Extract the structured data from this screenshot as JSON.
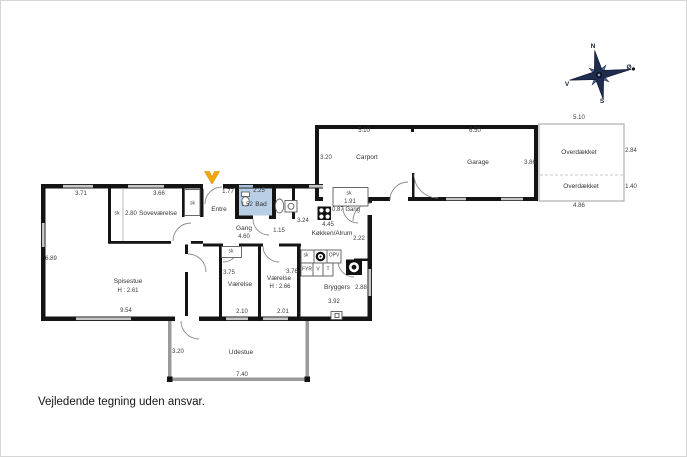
{
  "caption": "Vejledende tegning uden ansvar.",
  "colors": {
    "wall": "#141414",
    "window": "#c6c6c6",
    "bath_fill": "#b9cfe6",
    "entrance_marker": "#f3a70b",
    "compass_dark": "#1e2c4e",
    "compass_mid": "#4a6490"
  },
  "compass": {
    "n": "N",
    "e": "Ø",
    "s": "S",
    "v": "V"
  },
  "plan": {
    "house": {
      "spisestue": {
        "name": "Spisestue",
        "height": "H : 2.61",
        "dim_top": "3.71",
        "dim_left": "6.89",
        "dim_bottom": "9.54"
      },
      "sovevaerelse": {
        "name": "Soveværelse",
        "dim_top": "3.66",
        "dim_width": "2.80",
        "closet": "sk"
      },
      "entre": {
        "name": "Entre",
        "dim": "1.77",
        "closet": "sk"
      },
      "bad": {
        "name": "Bad",
        "dim_w": "2.25",
        "dim_h": "1.52"
      },
      "gang": {
        "name": "Gang",
        "dim": "4.60",
        "dim2": "1.15"
      },
      "koekken": {
        "name": "Køkken/Alrum",
        "dim1": "3.24",
        "dim2": "4.45",
        "dim3": "2.22",
        "closet": "sk",
        "closet_dim": "1.91",
        "gang_dim": "0.87 Gang"
      },
      "vaerelse1": {
        "name": "Værelse",
        "dim": "3.75",
        "dim_bottom": "2.10",
        "closet": "sk"
      },
      "vaerelse2": {
        "name": "Værelse",
        "height": "H : 2.66",
        "dim": "3.76",
        "dim_bottom": "2.01"
      },
      "bryggers": {
        "name": "Bryggers",
        "dim": "2.88",
        "dim_bottom": "3.92",
        "closet": "sk",
        "opv": "OPV",
        "fyr": "FYR",
        "v": "V",
        "t": "T"
      }
    },
    "carport": {
      "name": "Carport",
      "dim_top": "5.10",
      "dim_left": "3.20"
    },
    "garage": {
      "name": "Garage",
      "dim_top": "6.50",
      "dim_right": "3.86"
    },
    "overdaekket": {
      "dim_top": "5.10",
      "name1": "Overdækket",
      "dim1": "2.84",
      "name2": "Overdækket",
      "dim2": "1.40",
      "dim_bottom": "4.86"
    },
    "udestue": {
      "name": "Udestue",
      "dim_left": "3.20",
      "dim_bottom": "7.40"
    }
  }
}
